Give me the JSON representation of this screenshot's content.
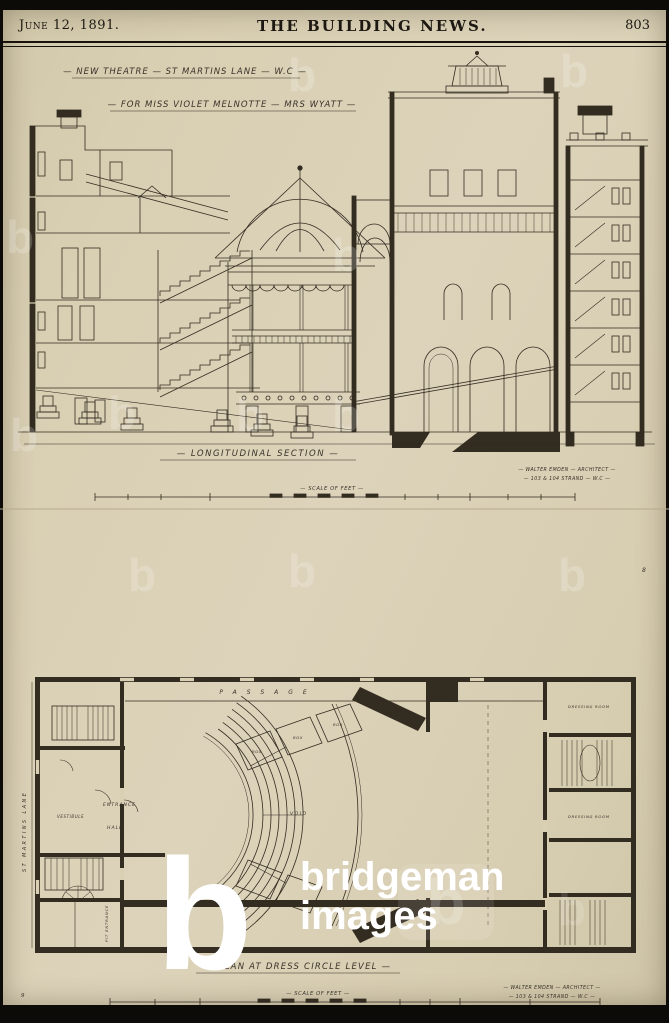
{
  "header": {
    "date": "June 12, 1891.",
    "title": "THE BUILDING NEWS.",
    "page_number": "803"
  },
  "section": {
    "title_line1": "— NEW THEATRE — ST MARTINS LANE — W.C —",
    "title_line2": "— FOR MISS VIOLET MELNOTTE — MRS WYATT —",
    "caption": "— LONGITUDINAL SECTION —",
    "architect_line1": "— WALTER EMDEN — ARCHITECT —",
    "architect_line2": "— 103 & 104 STRAND — W.C —",
    "scale_label": "— SCALE OF FEET —"
  },
  "plan": {
    "caption": "— PLAN AT DRESS CIRCLE LEVEL —",
    "architect_line1": "— WALTER EMDEN — ARCHITECT —",
    "architect_line2": "— 103 & 104 STRAND — W.C —",
    "scale_label": "— SCALE OF FEET —",
    "street_label": "ST MARTINS LANE",
    "plate_mark_top": "8",
    "plate_mark_bottom": "9",
    "rooms": {
      "passage": "PASSAGE",
      "entrance": "ENTRANCE",
      "hall": "HALL",
      "vestibule": "VESTIBULE",
      "void": "VOID",
      "box": "BOX",
      "dressing_room": "DRESSING ROOM",
      "pit_entrance": "PIT ENTRANCE"
    }
  },
  "watermark": {
    "letter": "b",
    "line1": "bridgeman",
    "line2": "images"
  },
  "colors": {
    "paper": "#d9cfb3",
    "ink": "#332c21",
    "band": "#0d0b08"
  }
}
